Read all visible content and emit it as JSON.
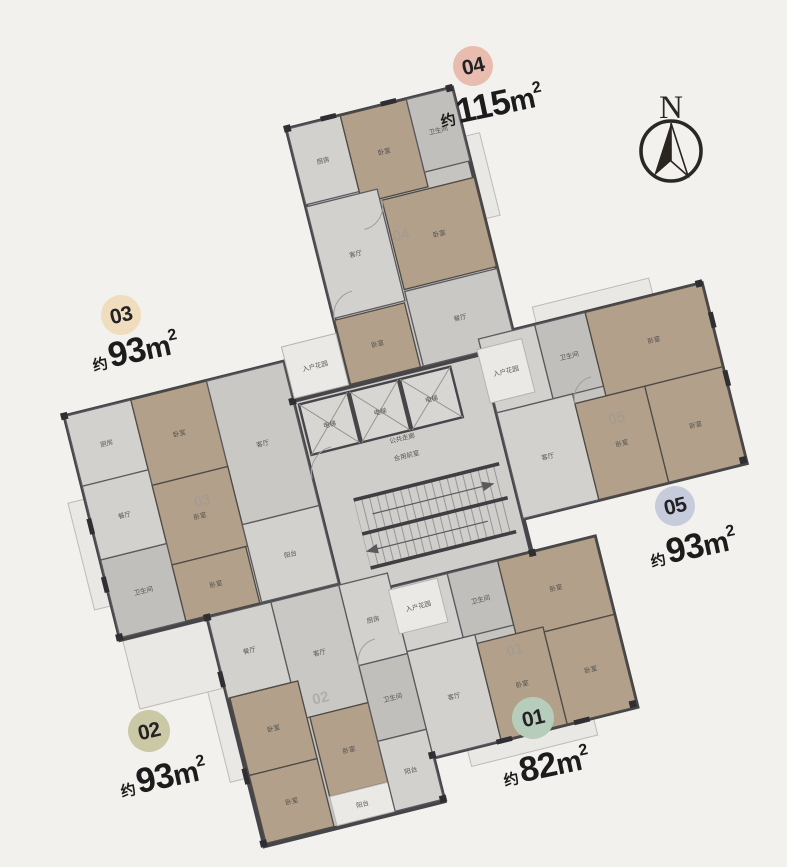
{
  "background_color": "#f2f1ee",
  "ink_color": "#1c1c1c",
  "compass": {
    "label": "N"
  },
  "units": [
    {
      "id": "01",
      "area_label": "约82m²",
      "approx": "约",
      "value": "82",
      "unit": "m",
      "sup": "2",
      "badge_color": "#b7cdbc"
    },
    {
      "id": "02",
      "area_label": "约93m²",
      "approx": "约",
      "value": "93",
      "unit": "m",
      "sup": "2",
      "badge_color": "#cbc8a6"
    },
    {
      "id": "03",
      "area_label": "约93m²",
      "approx": "约",
      "value": "93",
      "unit": "m",
      "sup": "2",
      "badge_color": "#efddbd"
    },
    {
      "id": "04",
      "area_label": "约115m²",
      "approx": "约",
      "value": "115",
      "unit": "m",
      "sup": "2",
      "badge_color": "#e9bcb0"
    },
    {
      "id": "05",
      "area_label": "约93m²",
      "approx": "约",
      "value": "93",
      "unit": "m",
      "sup": "2",
      "badge_color": "#c7ccdc"
    }
  ],
  "plan": {
    "wall_color": "#46464a",
    "room_fill_gray": "#cac8c5",
    "room_fill_tan": "#b2a08a",
    "room_labels": {
      "bedroom": "卧室",
      "living": "客厅",
      "dining": "餐厅",
      "kitchen": "厨房",
      "bath": "卫生间",
      "balcony": "阳台",
      "elevator": "电梯",
      "vestibule": "合用前室",
      "corridor": "公共走廊",
      "entry": "入户花园"
    },
    "rooms": [
      {
        "wing": "04",
        "x": -35,
        "y": -360,
        "w": 55,
        "h": 78,
        "kind": "gray2",
        "label": "kitchen"
      },
      {
        "wing": "04",
        "x": 20,
        "y": -360,
        "w": 68,
        "h": 90,
        "kind": "tan",
        "label": "bedroom"
      },
      {
        "wing": "04",
        "x": 88,
        "y": -360,
        "w": 47,
        "h": 75,
        "kind": "gray3",
        "label": "bath"
      },
      {
        "wing": "04",
        "x": 40,
        "y": -268,
        "w": 95,
        "h": 92,
        "kind": "tan",
        "label": "bedroom"
      },
      {
        "wing": "04",
        "x": -35,
        "y": -280,
        "w": 73,
        "h": 115,
        "kind": "gray2",
        "label": "living"
      },
      {
        "wing": "04",
        "x": -35,
        "y": -163,
        "w": 72,
        "h": 66,
        "kind": "tan",
        "label": "bedroom"
      },
      {
        "wing": "04",
        "x": 40,
        "y": -174,
        "w": 95,
        "h": 77,
        "kind": "gray",
        "label": "dining"
      },
      {
        "wing": "03",
        "x": -320,
        "y": -135,
        "w": 68,
        "h": 72,
        "kind": "gray2",
        "label": "kitchen"
      },
      {
        "wing": "03",
        "x": -252,
        "y": -135,
        "w": 78,
        "h": 88,
        "kind": "tan",
        "label": "bedroom"
      },
      {
        "wing": "03",
        "x": -174,
        "y": -135,
        "w": 79,
        "h": 148,
        "kind": "gray",
        "label": "living"
      },
      {
        "wing": "03",
        "x": -320,
        "y": -63,
        "w": 68,
        "h": 76,
        "kind": "gray2",
        "label": "dining"
      },
      {
        "wing": "03",
        "x": -252,
        "y": -47,
        "w": 78,
        "h": 82,
        "kind": "tan",
        "label": "bedroom"
      },
      {
        "wing": "03",
        "x": -320,
        "y": 13,
        "w": 68,
        "h": 80,
        "kind": "gray3",
        "label": "bath"
      },
      {
        "wing": "03",
        "x": -252,
        "y": 35,
        "w": 76,
        "h": 58,
        "kind": "tan",
        "label": "bedroom"
      },
      {
        "wing": "03",
        "x": -174,
        "y": 13,
        "w": 79,
        "h": 80,
        "kind": "gray2",
        "label": "balcony"
      },
      {
        "wing": "05",
        "x": 100,
        "y": -110,
        "w": 58,
        "h": 76,
        "kind": "gray2",
        "label": "kitchen"
      },
      {
        "wing": "05",
        "x": 158,
        "y": -110,
        "w": 52,
        "h": 76,
        "kind": "gray3",
        "label": "bath"
      },
      {
        "wing": "05",
        "x": 210,
        "y": -110,
        "w": 120,
        "h": 86,
        "kind": "tan",
        "label": "bedroom"
      },
      {
        "wing": "05",
        "x": 100,
        "y": -34,
        "w": 78,
        "h": 109,
        "kind": "gray2",
        "label": "living"
      },
      {
        "wing": "05",
        "x": 178,
        "y": -24,
        "w": 72,
        "h": 99,
        "kind": "tan",
        "label": "bedroom"
      },
      {
        "wing": "05",
        "x": 250,
        "y": -24,
        "w": 80,
        "h": 99,
        "kind": "tan",
        "label": "bedroom"
      },
      {
        "wing": "01",
        "x": -45,
        "y": 110,
        "w": 58,
        "h": 66,
        "kind": "gray2",
        "label": "kitchen"
      },
      {
        "wing": "01",
        "x": 13,
        "y": 110,
        "w": 52,
        "h": 66,
        "kind": "gray3",
        "label": "bath"
      },
      {
        "wing": "01",
        "x": 65,
        "y": 110,
        "w": 100,
        "h": 80,
        "kind": "tan",
        "label": "bedroom"
      },
      {
        "wing": "01",
        "x": -45,
        "y": 176,
        "w": 70,
        "h": 109,
        "kind": "gray2",
        "label": "living"
      },
      {
        "wing": "01",
        "x": 25,
        "y": 185,
        "w": 68,
        "h": 100,
        "kind": "tan",
        "label": "bedroom"
      },
      {
        "wing": "01",
        "x": 93,
        "y": 190,
        "w": 72,
        "h": 95,
        "kind": "tan",
        "label": "bedroom"
      },
      {
        "wing": "02",
        "x": -230,
        "y": 95,
        "w": 65,
        "h": 83,
        "kind": "gray2",
        "label": "dining"
      },
      {
        "wing": "02",
        "x": -165,
        "y": 95,
        "w": 70,
        "h": 121,
        "kind": "gray",
        "label": "living"
      },
      {
        "wing": "02",
        "x": -95,
        "y": 95,
        "w": 50,
        "h": 83,
        "kind": "gray2",
        "label": "kitchen"
      },
      {
        "wing": "02",
        "x": -228,
        "y": 178,
        "w": 70,
        "h": 80,
        "kind": "tan",
        "label": "bedroom"
      },
      {
        "wing": "02",
        "x": -155,
        "y": 216,
        "w": 60,
        "h": 82,
        "kind": "tan",
        "label": "bedroom"
      },
      {
        "wing": "02",
        "x": -228,
        "y": 258,
        "w": 70,
        "h": 70,
        "kind": "tan",
        "label": "bedroom"
      },
      {
        "wing": "02",
        "x": -95,
        "y": 178,
        "w": 50,
        "h": 78,
        "kind": "gray3",
        "label": "bath"
      },
      {
        "wing": "02",
        "x": -155,
        "y": 298,
        "w": 60,
        "h": 30,
        "kind": "light",
        "label": "balcony"
      },
      {
        "wing": "02",
        "x": -95,
        "y": 256,
        "w": 50,
        "h": 72,
        "kind": "gray2",
        "label": "balcony"
      }
    ],
    "marks": [
      {
        "x": -38,
        "y": -364,
        "w": 7,
        "h": 7
      },
      {
        "x": 129,
        "y": -364,
        "w": 7,
        "h": 7
      },
      {
        "x": -99,
        "y": -98,
        "w": 7,
        "h": 7
      },
      {
        "x": 97,
        "y": -98,
        "w": 7,
        "h": 7
      },
      {
        "x": -324,
        "y": -139,
        "w": 7,
        "h": 7
      },
      {
        "x": -324,
        "y": 89,
        "w": 7,
        "h": 7
      },
      {
        "x": 324,
        "y": -114,
        "w": 7,
        "h": 7
      },
      {
        "x": 324,
        "y": 68,
        "w": 7,
        "h": 7
      },
      {
        "x": 158,
        "y": 278,
        "w": 7,
        "h": 7
      },
      {
        "x": -49,
        "y": 279,
        "w": 7,
        "h": 7
      },
      {
        "x": -234,
        "y": 91,
        "w": 7,
        "h": 7
      },
      {
        "x": -234,
        "y": 324,
        "w": 7,
        "h": 7
      },
      {
        "x": -49,
        "y": 324,
        "w": 7,
        "h": 7
      },
      {
        "x": 97,
        "y": 107,
        "w": 7,
        "h": 7
      },
      {
        "x": 0,
        "y": -364,
        "w": 16,
        "h": 5
      },
      {
        "x": 62,
        "y": -364,
        "w": 16,
        "h": 5
      },
      {
        "x": -324,
        "y": -30,
        "w": 5,
        "h": 16
      },
      {
        "x": -324,
        "y": 30,
        "w": 5,
        "h": 16
      },
      {
        "x": 329,
        "y": -80,
        "w": 5,
        "h": 16
      },
      {
        "x": 329,
        "y": -20,
        "w": 5,
        "h": 16
      },
      {
        "x": 20,
        "y": 283,
        "w": 16,
        "h": 5
      },
      {
        "x": 100,
        "y": 283,
        "w": 16,
        "h": 5
      },
      {
        "x": -234,
        "y": 150,
        "w": 5,
        "h": 16
      },
      {
        "x": -234,
        "y": 250,
        "w": 5,
        "h": 16
      }
    ]
  }
}
